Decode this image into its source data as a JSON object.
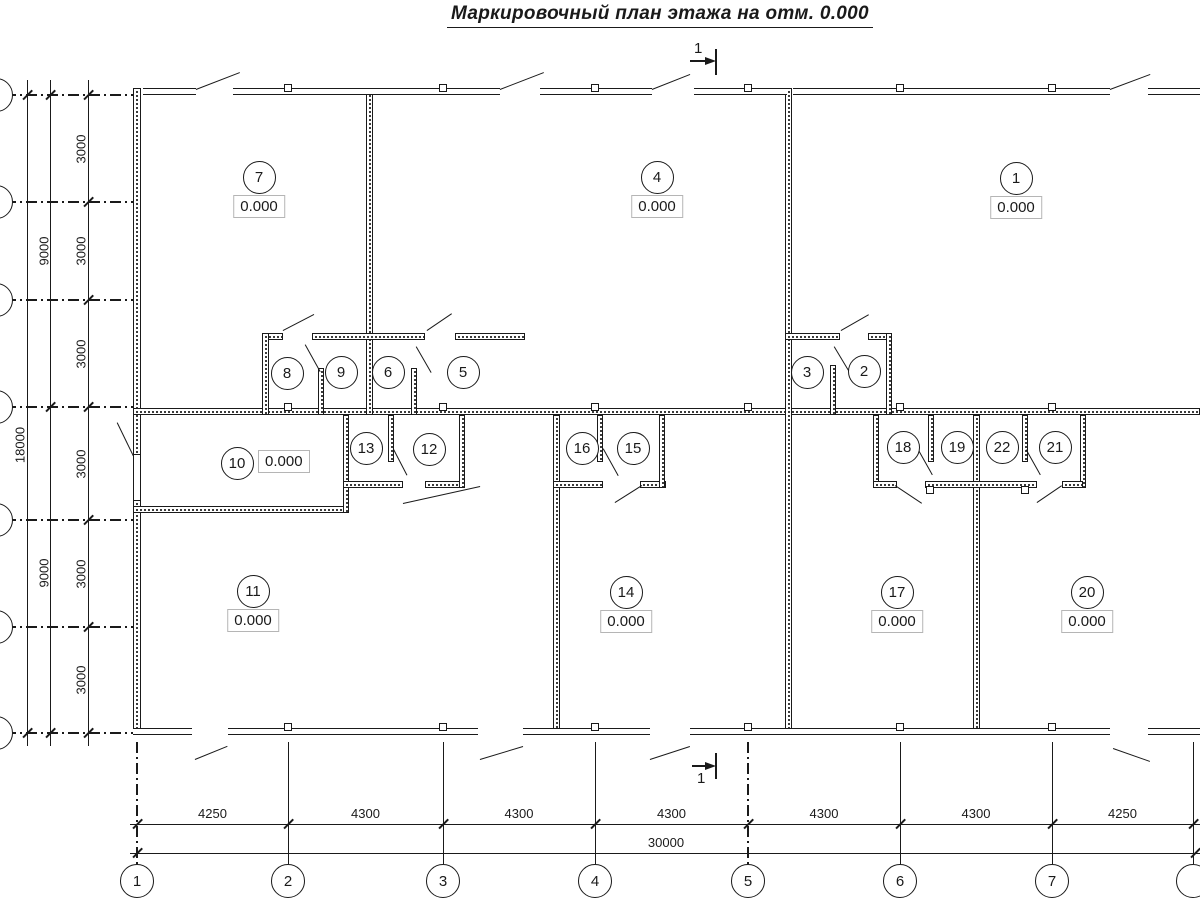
{
  "title": "Маркировочный план этажа на отм. 0.000",
  "ink_color": "#1a1a1a",
  "section_marks": {
    "top": "1",
    "bottom": "1"
  },
  "axes": {
    "bottom_labels": [
      "1",
      "2",
      "3",
      "4",
      "5",
      "6",
      "7",
      ""
    ]
  },
  "dimensions": {
    "bottom": {
      "segments": [
        "4250",
        "4300",
        "4300",
        "4300",
        "4300",
        "4300",
        "4250"
      ],
      "total": "30000"
    },
    "left": {
      "segments": [
        "3000",
        "3000",
        "3000",
        "3000",
        "3000",
        "3000"
      ],
      "intermediate": [
        "9000",
        "9000"
      ],
      "total": "18000"
    }
  },
  "rooms": [
    {
      "number": "7",
      "elevation": "0.000",
      "cx": 259,
      "cy": 177,
      "layout": "below"
    },
    {
      "number": "4",
      "elevation": "0.000",
      "cx": 657,
      "cy": 177,
      "layout": "below"
    },
    {
      "number": "1",
      "elevation": "0.000",
      "cx": 1016,
      "cy": 178,
      "layout": "below"
    },
    {
      "number": "8",
      "elevation": null,
      "cx": 287,
      "cy": 373
    },
    {
      "number": "9",
      "elevation": null,
      "cx": 341,
      "cy": 372
    },
    {
      "number": "6",
      "elevation": null,
      "cx": 388,
      "cy": 372
    },
    {
      "number": "5",
      "elevation": null,
      "cx": 463,
      "cy": 372
    },
    {
      "number": "3",
      "elevation": null,
      "cx": 807,
      "cy": 372
    },
    {
      "number": "2",
      "elevation": null,
      "cx": 864,
      "cy": 371
    },
    {
      "number": "10",
      "elevation": "0.000",
      "cx": 237,
      "cy": 463,
      "layout": "right"
    },
    {
      "number": "13",
      "elevation": null,
      "cx": 366,
      "cy": 448
    },
    {
      "number": "12",
      "elevation": null,
      "cx": 429,
      "cy": 449
    },
    {
      "number": "16",
      "elevation": null,
      "cx": 582,
      "cy": 448
    },
    {
      "number": "15",
      "elevation": null,
      "cx": 633,
      "cy": 448
    },
    {
      "number": "18",
      "elevation": null,
      "cx": 903,
      "cy": 447
    },
    {
      "number": "19",
      "elevation": null,
      "cx": 957,
      "cy": 447
    },
    {
      "number": "22",
      "elevation": null,
      "cx": 1002,
      "cy": 447
    },
    {
      "number": "21",
      "elevation": null,
      "cx": 1055,
      "cy": 447
    },
    {
      "number": "11",
      "elevation": "0.000",
      "cx": 253,
      "cy": 591,
      "layout": "below"
    },
    {
      "number": "14",
      "elevation": "0.000",
      "cx": 626,
      "cy": 592,
      "layout": "below"
    },
    {
      "number": "17",
      "elevation": "0.000",
      "cx": 897,
      "cy": 592,
      "layout": "below"
    },
    {
      "number": "20",
      "elevation": "0.000",
      "cx": 1087,
      "cy": 592,
      "layout": "below"
    }
  ]
}
